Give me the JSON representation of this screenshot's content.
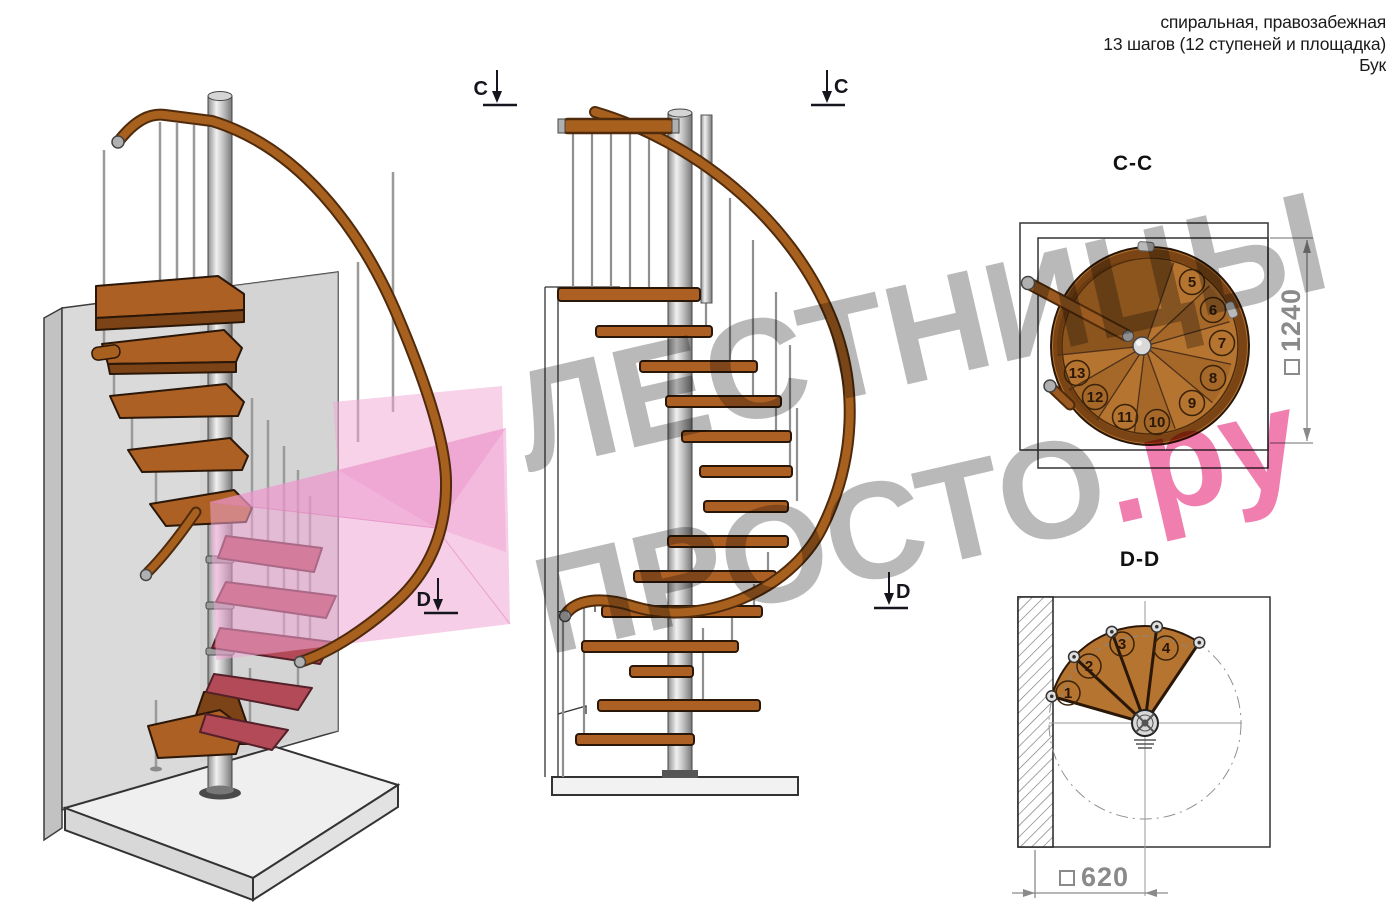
{
  "title_block": {
    "line1": "спиральная, правозабежная",
    "line2": "13 шагов (12 ступеней и площадка)",
    "line3": "Бук"
  },
  "section_markers": {
    "c": "C",
    "d": "D"
  },
  "cc_plan": {
    "title": "C-C",
    "step_labels": [
      "5",
      "6",
      "7",
      "8",
      "9",
      "10",
      "11",
      "12",
      "13"
    ],
    "dimension_symbol": "□",
    "dimension_value": "1240"
  },
  "dd_plan": {
    "title": "D-D",
    "step_labels": [
      "1",
      "2",
      "3",
      "4"
    ],
    "dimension_symbol": "□",
    "dimension_value": "620"
  },
  "watermark": {
    "word1": "ЛЕСТНИЦЫ",
    "word2": "ПРОСТО",
    "word2_suffix": ".ру"
  },
  "colors": {
    "ink": "#1a1a1a",
    "wood": "#ad6023",
    "wood_light": "#b5742f",
    "wood_dark": "#7c4316",
    "step_red": "#b24a57",
    "metal": "#c0c0c0",
    "highlight_pink": "#f0a5d3",
    "wmgray": "#b9b9b9",
    "wmpink": "#f07fb0",
    "dim": "#8a8a8a"
  }
}
